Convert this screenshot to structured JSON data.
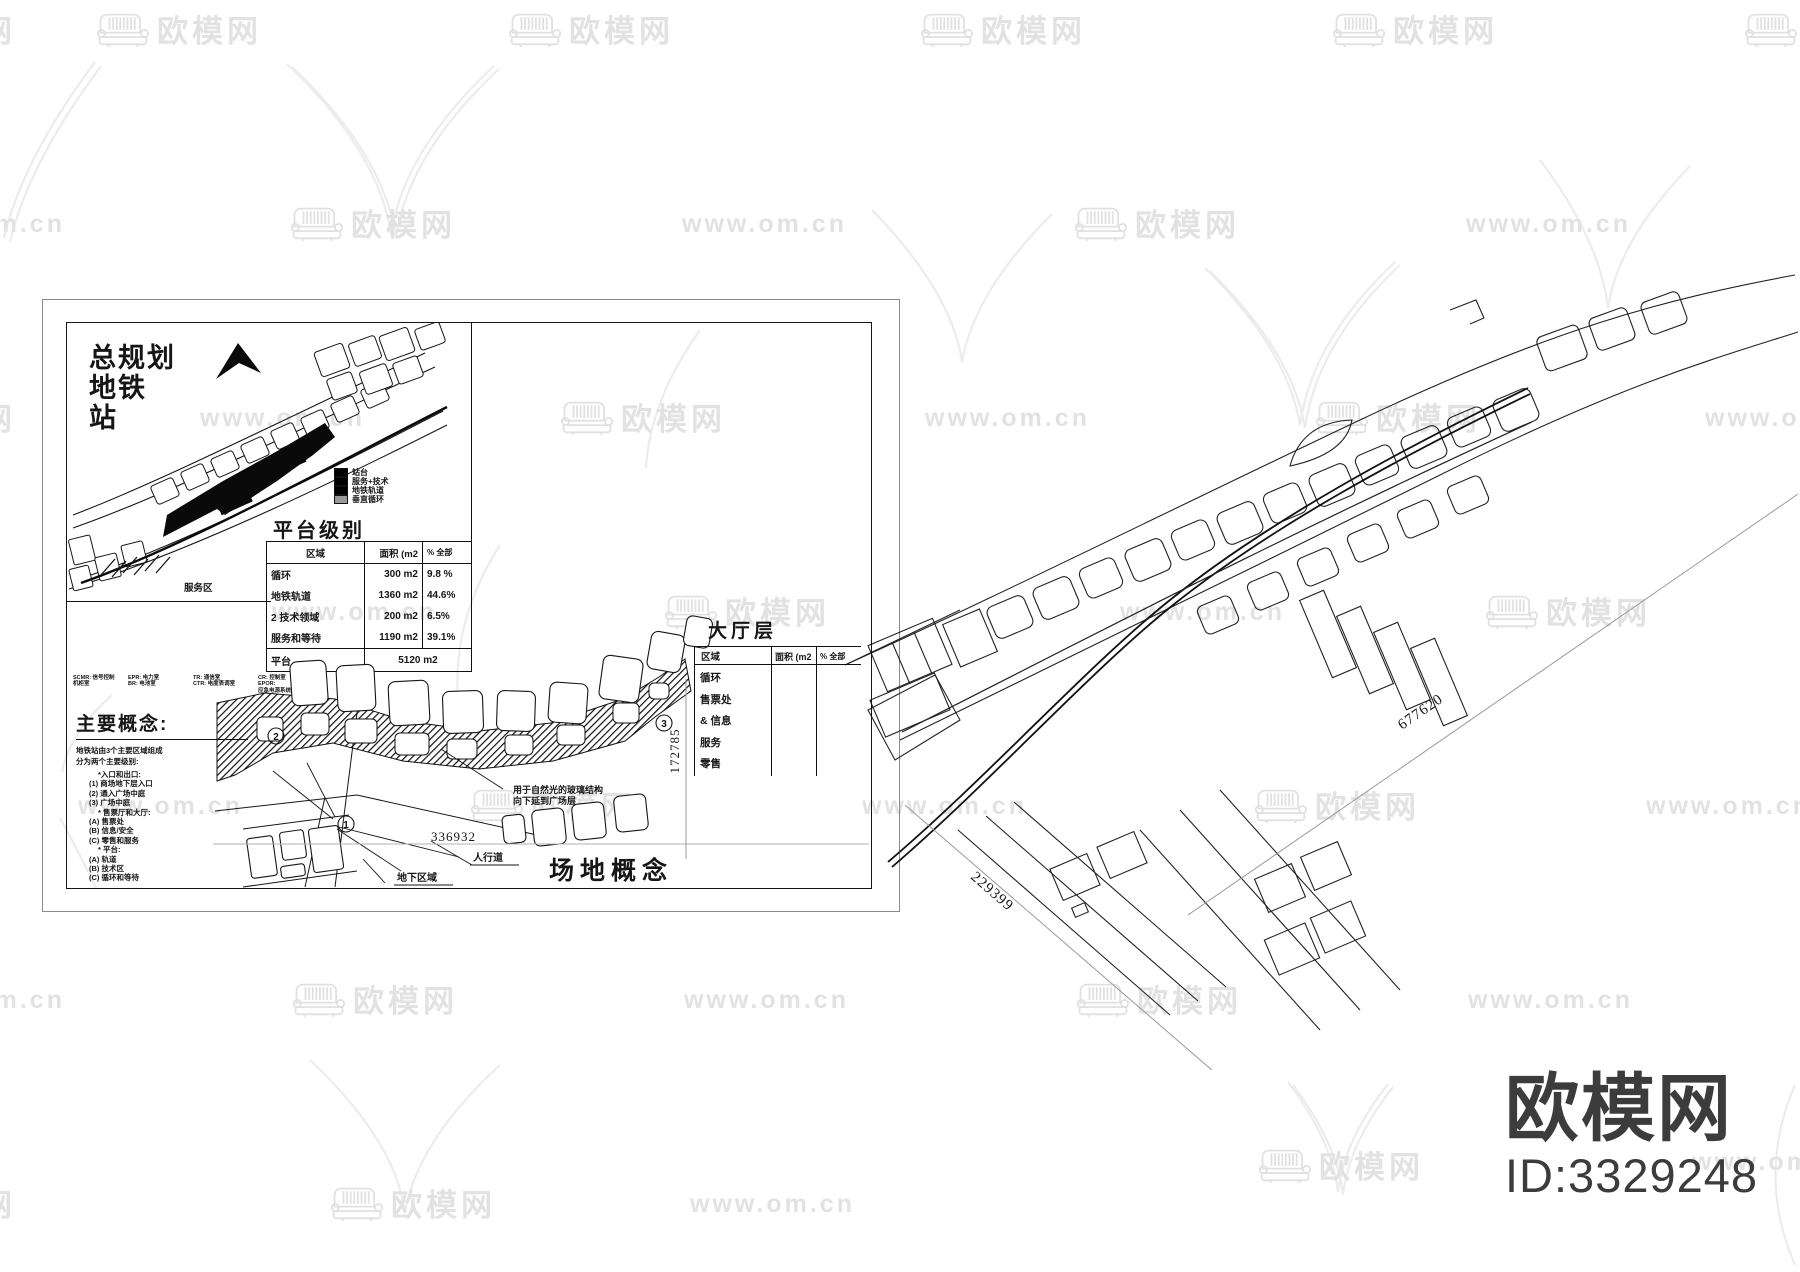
{
  "watermark": {
    "brand": "欧模网",
    "url": "www.om.cn"
  },
  "logo": {
    "brand": "欧模网",
    "id": "ID:3329248"
  },
  "master_plan": {
    "title_line1": "总规划",
    "title_line2": "地铁",
    "title_line3": "站",
    "service_area": "服务区",
    "legend": [
      {
        "label": "站台"
      },
      {
        "label": "服务+技术"
      },
      {
        "label": "地铁轨道"
      },
      {
        "label": "垂直循环"
      }
    ]
  },
  "platform_table": {
    "title": "平台级别",
    "col_region": "区域",
    "col_area": "面积 (m2",
    "col_pct": "% 全部",
    "rows": [
      {
        "region": "循环",
        "area": "300 m2",
        "pct": "9.8 %"
      },
      {
        "region": "地铁轨道",
        "area": "1360 m2",
        "pct": "44.6%"
      },
      {
        "region": "2 技术领域",
        "area": "200 m2",
        "pct": "6.5%"
      },
      {
        "region": "服务和等待",
        "area": "1190 m2",
        "pct": "39.1%"
      }
    ],
    "total_label": "平台",
    "total_value": "5120 m2"
  },
  "abbreviations": {
    "c1l1": "SCMR: 信号控制",
    "c1l2": "机柜室",
    "c2l1": "EPR: 电力室",
    "c2l2": "BR: 电池室",
    "c3l1": "TR: 通信室",
    "c3l2": "CTR: 电度表调室",
    "c4l1": "CR: 控制室",
    "c4l2": "EPOR:",
    "c4l3": "应急电源系统室"
  },
  "concepts": {
    "title": "主要概念:",
    "intro1": "地铁站由3个主要区域组成",
    "intro2": "分为两个主要级别:",
    "items": [
      "*入口和出口:",
      "(1) 商场地下层入口",
      "(2) 通入广场中庭",
      "(3) 广场中庭",
      "* 售票厅和大厅:",
      "(A) 售票处",
      "(B) 信息/安全",
      "(C) 零售和服务",
      "* 平台:",
      "(A) 轨道",
      "(B) 技术区",
      "(C) 循环和等待"
    ]
  },
  "hall_table": {
    "title": "大厅层",
    "col_region": "区域",
    "col_area": "面积 (m2",
    "col_pct": "% 全部",
    "rows": [
      "循环",
      "售票处",
      "& 信息",
      "服务",
      "零售"
    ]
  },
  "site_concept": {
    "title": "场地概念",
    "dim_width": "336932",
    "dim_height": "172785",
    "label_sidewalk": "人行道",
    "label_underground": "地下区域",
    "note1": "用于自然光的玻璃结构",
    "note2": "向下延到广场层",
    "marker1": "1",
    "marker2": "2",
    "marker3": "3"
  },
  "overall_plan": {
    "dim_long": "677620",
    "dim_short": "229399"
  }
}
